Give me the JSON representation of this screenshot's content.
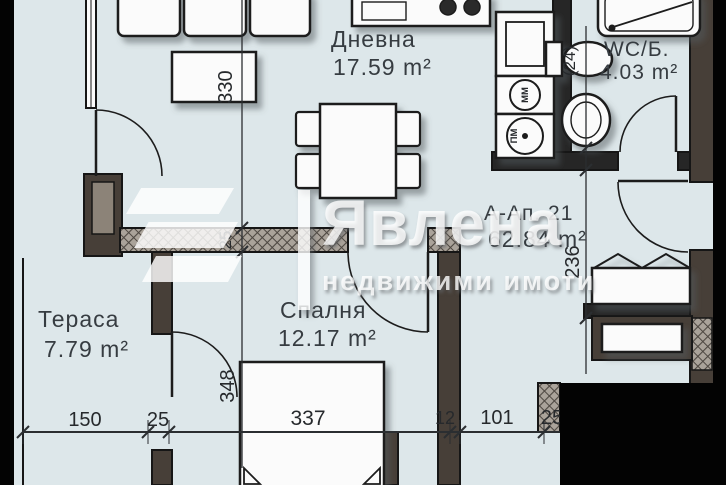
{
  "watermark": {
    "logo_icon": "flag-icon",
    "brand": "Явлена",
    "tagline": "недвижими имоти"
  },
  "apartment": {
    "label": "А-Ап. 21",
    "area": "62.84 m²"
  },
  "rooms": {
    "living": {
      "name": "Дневна",
      "area": "17.59 m²"
    },
    "wc": {
      "name": "WC/Б.",
      "area": "4.03 m²"
    },
    "bedroom": {
      "name": "Спалня",
      "area": "12.17 m²"
    },
    "terrace": {
      "name": "Тераса",
      "area": "7.79 m²"
    }
  },
  "appliances": {
    "dishwasher": "ММ",
    "washer": "ПМ"
  },
  "dimensions": {
    "bottom": [
      "150",
      "25",
      "337",
      "12",
      "101",
      "25"
    ],
    "left_chain": [
      "330",
      "25",
      "348"
    ],
    "right_chain": [
      "(24)",
      "236"
    ]
  },
  "colors": {
    "floor": "#dde7ea",
    "wall_dark": "#473f38",
    "wall_black": "#262626",
    "hatch_fill": "#aaa39a",
    "crop_black": "#030303",
    "label_text": "#363c41",
    "watermark_white": "#ffffff"
  }
}
